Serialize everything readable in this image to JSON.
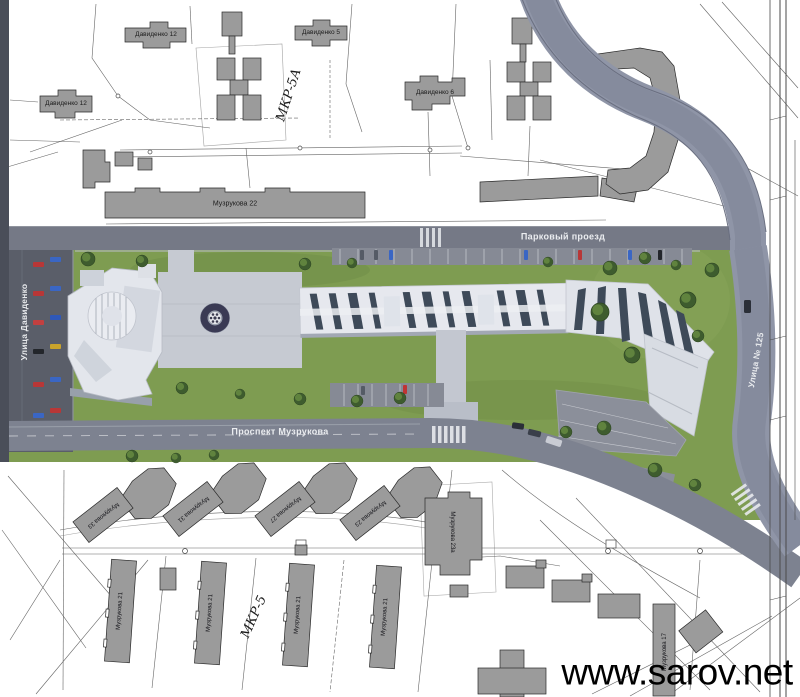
{
  "labels": {
    "davidenko12_nw": "Давиденко 12",
    "davidenko12_w": "Давиденко 12",
    "davidenko5": "Давиденко 5",
    "davidenko6": "Давиденко 6",
    "muzrukova22": "Музрукова 22",
    "mkr5a": "МКР-5А",
    "mkr5": "МКР-5",
    "parkovy_proezd": "Парковый проезд",
    "ulitsa_davidenko": "Улица Давиденко",
    "prospekt_muzrukova": "Проспект Музрукова",
    "ulitsa_125": "Улица № 125",
    "muzrukova33": "Музрукова 33",
    "muzrukova31": "Музрукова 31",
    "muzrukova27": "Музрукова 27",
    "muzrukova23": "Музрукова 23",
    "muzrukova21": "Музрукова 21",
    "muzrukova23a": "Музрукова 23а",
    "muzrukova17": "Музрукова 17"
  },
  "watermark": "www.sarov.net",
  "colors": {
    "map_building": "#9b9b9b",
    "map_line": "#4a4a4a",
    "lawn": "#7e9c51",
    "tree": "#3e5c2e",
    "road": "#757986",
    "road_curved": "#8f95a7",
    "street_dark": "#5a5e69",
    "building_white": "#e6e8ee",
    "roof_glass": "#3e4a59",
    "plaza": "#c6cad2",
    "fountain_ring": "#3a3a54",
    "car_red": "#b83737",
    "car_blue": "#3a66c4",
    "car_yellow": "#caa42c",
    "watermark_text": "#000000"
  }
}
